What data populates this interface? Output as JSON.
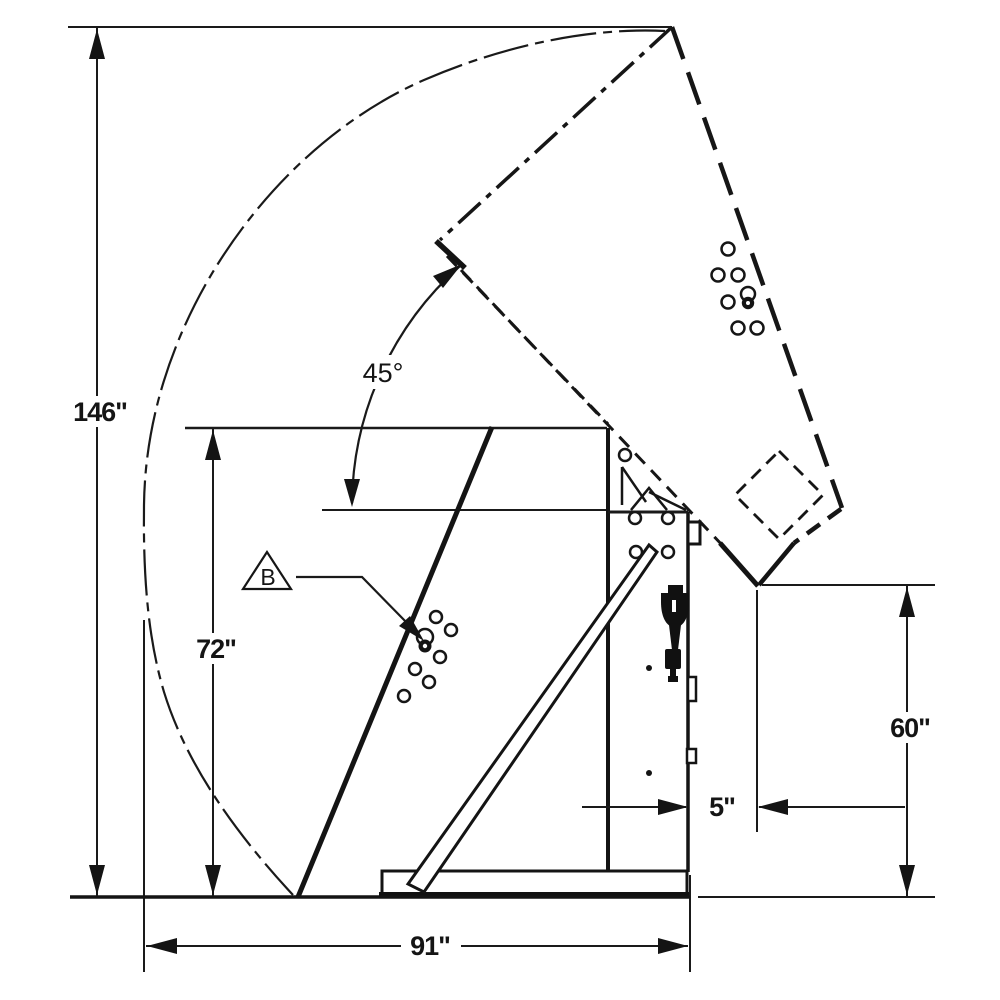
{
  "drawing": {
    "dimensions": {
      "overall_height": "146\"",
      "body_height": "72\"",
      "base_width": "91\"",
      "clearance": "5\"",
      "dump_height": "60\"",
      "tilt_angle": "45°"
    },
    "callouts": {
      "pivot_label": "B"
    },
    "colors": {
      "line": "#1a1a1a",
      "background": "#ffffff"
    }
  }
}
